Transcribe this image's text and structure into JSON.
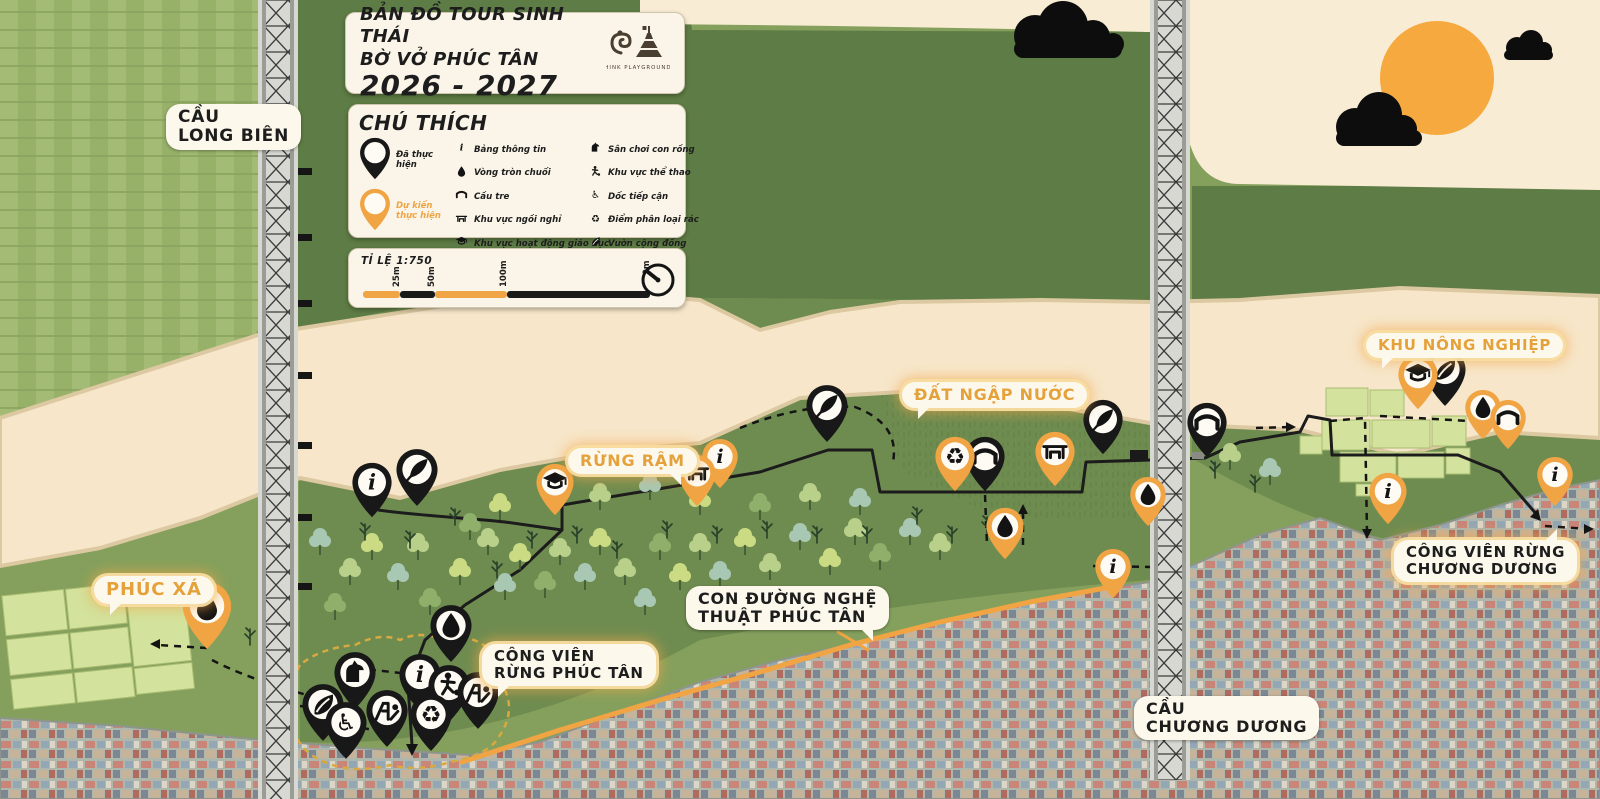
{
  "title_card": {
    "line1": "BẢN ĐỒ TOUR SINH THÁI",
    "line2": "BỜ VỞ PHÚC TÂN",
    "years": "2026 - 2027",
    "logo_caption": "THINK PLAYGROUNDS"
  },
  "legend": {
    "heading": "CHÚ THÍCH",
    "status": [
      {
        "icon": "pin-done",
        "color": "#181818",
        "label": "Đã thực hiện"
      },
      {
        "icon": "pin-planned",
        "color": "#F0A443",
        "label": "Dự kiến thực hiện"
      }
    ],
    "items": [
      {
        "icon": "info",
        "label": "Bảng thông tin"
      },
      {
        "icon": "droplet",
        "label": "Vòng tròn chuối"
      },
      {
        "icon": "bamboo-bridge",
        "label": "Cầu tre"
      },
      {
        "icon": "bench",
        "label": "Khu vực ngồi nghỉ"
      },
      {
        "icon": "education",
        "label": "Khu vực hoạt động giáo dục"
      },
      {
        "icon": "bird-watching",
        "label": "Khu vực quan sát chim"
      },
      {
        "icon": "dragon-playground",
        "label": "Sân chơi con rồng"
      },
      {
        "icon": "sports",
        "label": "Khu vực thể thao"
      },
      {
        "icon": "accessible-ramp",
        "label": "Dốc tiếp cận"
      },
      {
        "icon": "recycling",
        "label": "Điểm phân loại rác"
      },
      {
        "icon": "community-garden",
        "label": "Vườn cộng đồng"
      },
      {
        "icon": "playground",
        "label": "Sân chơi"
      }
    ]
  },
  "scale_card": {
    "label": "TỈ LỆ 1:750",
    "ticks": [
      {
        "text": "25m",
        "x": 37
      },
      {
        "text": "50m",
        "x": 72
      },
      {
        "text": "100m",
        "x": 144
      },
      {
        "text": "200m",
        "x": 287
      }
    ],
    "segments": [
      {
        "from": 0,
        "to": 37,
        "color": "#F0A443"
      },
      {
        "from": 37,
        "to": 72,
        "color": "#1a1a1a"
      },
      {
        "from": 72,
        "to": 144,
        "color": "#F0A443"
      },
      {
        "from": 144,
        "to": 287,
        "color": "#1a1a1a"
      }
    ]
  },
  "map_labels": [
    {
      "id": "cau-long-bien",
      "lines": [
        "CẦU",
        "LONG BIÊN"
      ],
      "style": "plain",
      "tail": "none",
      "x": 166,
      "y": 104,
      "fs": 17
    },
    {
      "id": "phuc-xa",
      "lines": [
        "PHÚC XÁ"
      ],
      "style": "orange",
      "tail": "bl",
      "x": 94,
      "y": 576,
      "fs": 18
    },
    {
      "id": "rung-ram",
      "lines": [
        "RỪNG RẬM"
      ],
      "style": "orange",
      "tail": "br",
      "x": 568,
      "y": 448,
      "fs": 16
    },
    {
      "id": "dat-ngap-nuoc",
      "lines": [
        "ĐẤT NGẬP NƯỚC"
      ],
      "style": "orange",
      "tail": "bl",
      "x": 902,
      "y": 382,
      "fs": 16
    },
    {
      "id": "khu-nong-nghiep",
      "lines": [
        "KHU NÔNG NGHIỆP"
      ],
      "style": "orange",
      "tail": "bl",
      "x": 1366,
      "y": 333,
      "fs": 15
    },
    {
      "id": "cong-vien-rung-phuc-tan",
      "lines": [
        "CÔNG VIÊN",
        "RỪNG PHÚC TÂN"
      ],
      "style": "glow",
      "tail": "bl",
      "x": 482,
      "y": 644,
      "fs": 15
    },
    {
      "id": "con-duong-nghe-thuat",
      "lines": [
        "CON ĐƯỜNG NGHỆ",
        "THUẬT PHÚC TÂN"
      ],
      "style": "plain",
      "tail": "br",
      "x": 686,
      "y": 586,
      "fs": 16
    },
    {
      "id": "cong-vien-rung-chuong-duong",
      "lines": [
        "CÔNG VIÊN RỪNG",
        "CHƯƠNG DƯƠNG"
      ],
      "style": "glow",
      "tail": "tr",
      "x": 1394,
      "y": 540,
      "fs": 15
    },
    {
      "id": "cau-chuong-duong",
      "lines": [
        "CẦU",
        "CHƯƠNG DƯƠNG"
      ],
      "style": "plain",
      "tail": "none",
      "x": 1134,
      "y": 696,
      "fs": 16
    }
  ],
  "pins": [
    {
      "x": 372,
      "y": 518,
      "c": "black",
      "i": "info",
      "s": 42
    },
    {
      "x": 417,
      "y": 507,
      "c": "black",
      "i": "bird-watching",
      "s": 44
    },
    {
      "x": 827,
      "y": 443,
      "c": "black",
      "i": "bird-watching",
      "s": 44
    },
    {
      "x": 985,
      "y": 492,
      "c": "black",
      "i": "bamboo-bridge",
      "s": 42
    },
    {
      "x": 1103,
      "y": 455,
      "c": "black",
      "i": "bird-watching",
      "s": 42
    },
    {
      "x": 1207,
      "y": 458,
      "c": "black",
      "i": "bamboo-bridge",
      "s": 42
    },
    {
      "x": 1445,
      "y": 407,
      "c": "black",
      "i": "community-garden",
      "s": 44
    },
    {
      "x": 451,
      "y": 663,
      "c": "black",
      "i": "droplet",
      "s": 44
    },
    {
      "x": 355,
      "y": 710,
      "c": "black",
      "i": "dragon-playground",
      "s": 44
    },
    {
      "x": 420,
      "y": 712,
      "c": "black",
      "i": "info",
      "s": 44
    },
    {
      "x": 449,
      "y": 723,
      "c": "black",
      "i": "sports",
      "s": 44
    },
    {
      "x": 478,
      "y": 730,
      "c": "black",
      "i": "playground",
      "s": 44
    },
    {
      "x": 323,
      "y": 742,
      "c": "black",
      "i": "community-garden",
      "s": 44
    },
    {
      "x": 346,
      "y": 760,
      "c": "black",
      "i": "accessible-ramp",
      "s": 44
    },
    {
      "x": 387,
      "y": 748,
      "c": "black",
      "i": "playground",
      "s": 44
    },
    {
      "x": 431,
      "y": 752,
      "c": "black",
      "i": "recycling",
      "s": 44
    },
    {
      "x": 207,
      "y": 650,
      "c": "orange",
      "i": "droplet",
      "s": 52
    },
    {
      "x": 555,
      "y": 516,
      "c": "orange",
      "i": "education",
      "s": 40
    },
    {
      "x": 697,
      "y": 507,
      "c": "orange",
      "i": "bench",
      "s": 40
    },
    {
      "x": 720,
      "y": 489,
      "c": "orange",
      "i": "info",
      "s": 38
    },
    {
      "x": 955,
      "y": 492,
      "c": "orange",
      "i": "recycling",
      "s": 42
    },
    {
      "x": 1055,
      "y": 487,
      "c": "orange",
      "i": "bench",
      "s": 42
    },
    {
      "x": 1005,
      "y": 560,
      "c": "orange",
      "i": "droplet",
      "s": 40
    },
    {
      "x": 1148,
      "y": 527,
      "c": "orange",
      "i": "droplet",
      "s": 38
    },
    {
      "x": 1113,
      "y": 599,
      "c": "orange",
      "i": "info",
      "s": 38
    },
    {
      "x": 1388,
      "y": 525,
      "c": "orange",
      "i": "info",
      "s": 40
    },
    {
      "x": 1418,
      "y": 410,
      "c": "orange",
      "i": "education",
      "s": 42
    },
    {
      "x": 1483,
      "y": 440,
      "c": "orange",
      "i": "droplet",
      "s": 38
    },
    {
      "x": 1508,
      "y": 450,
      "c": "orange",
      "i": "bamboo-bridge",
      "s": 38
    },
    {
      "x": 1555,
      "y": 507,
      "c": "orange",
      "i": "info",
      "s": 38
    }
  ],
  "colors": {
    "accent_orange": "#F0A443",
    "pin_black": "#181818",
    "bubble_orange_text": "#E5A13A",
    "river_cream": "#F7E6C9",
    "card_bg": "#FAF5E8",
    "sun": "#F5A93E",
    "farm_plot": "#D3E29C",
    "forest_dark": "#5E7C45"
  }
}
